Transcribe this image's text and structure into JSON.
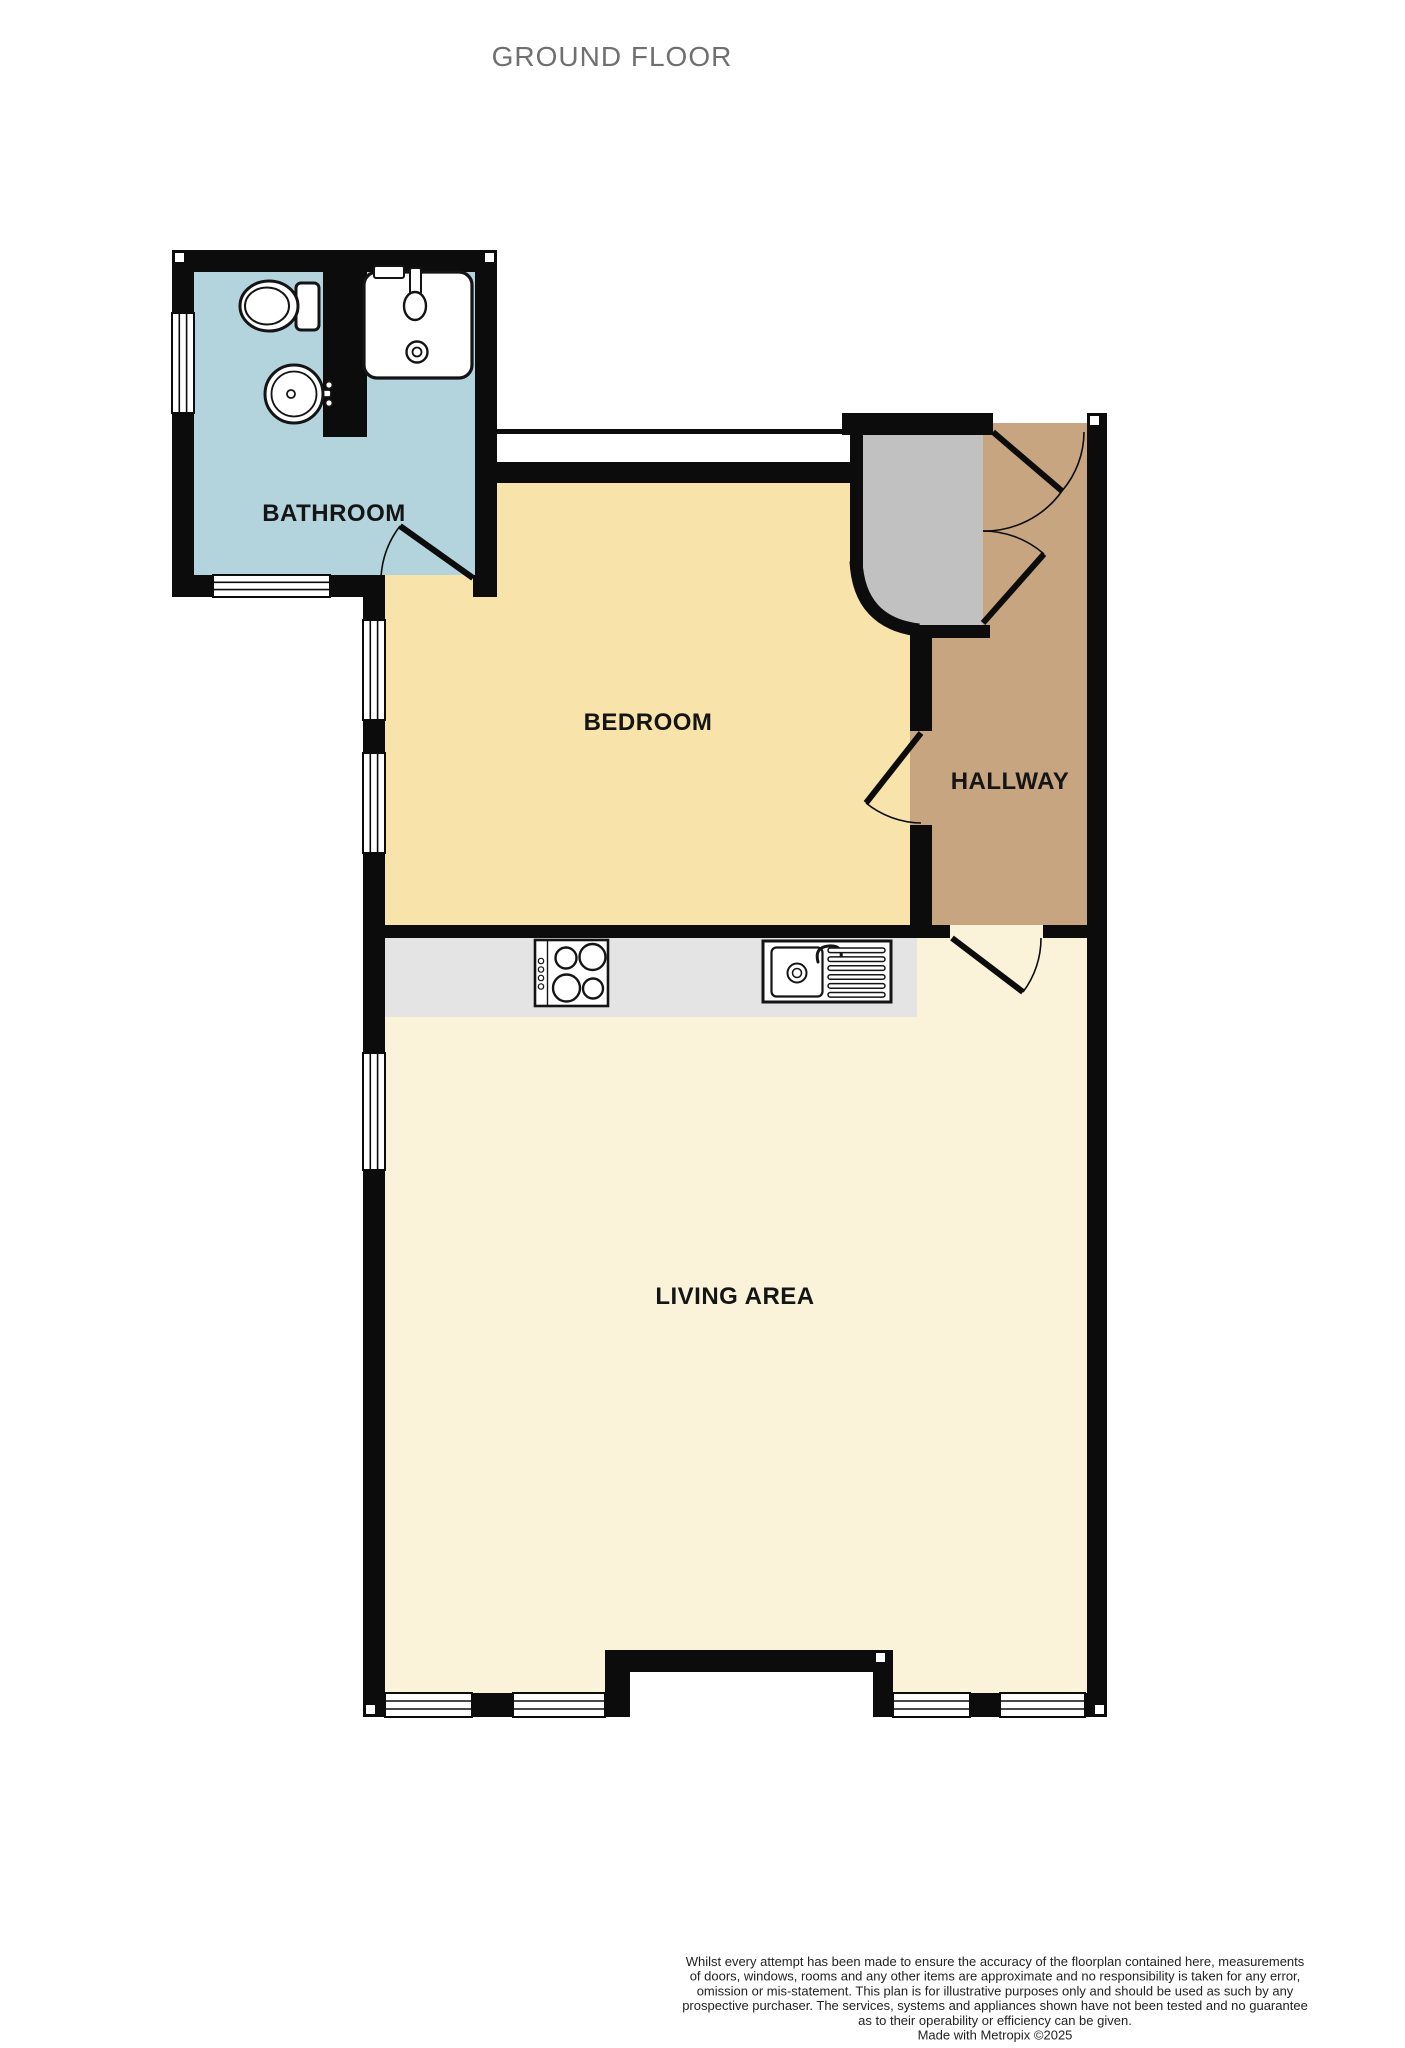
{
  "title": "GROUND FLOOR",
  "rooms": {
    "bathroom": {
      "label": "BATHROOM"
    },
    "bedroom": {
      "label": "BEDROOM"
    },
    "hallway": {
      "label": "HALLWAY"
    },
    "living_area": {
      "label": "LIVING AREA"
    }
  },
  "fixtures": {
    "bathroom": [
      "toilet-icon",
      "pedestal-basin-icon",
      "washbasin-icon"
    ],
    "kitchen": [
      "hob-icon",
      "sink-drainer-icon"
    ]
  },
  "colors": {
    "bathroom_floor": "#b4d4dd",
    "bedroom_floor": "#f8e4ab",
    "hallway_floor": "#c6a580",
    "living_floor": "#faf3da",
    "vestibule_floor": "#c2c1c1",
    "counter_floor": "#e4e4e4",
    "wall": "#0c0c0c",
    "title_text": "#6f6f6f",
    "label_text": "#151515",
    "disclaimer_text": "#222222"
  },
  "disclaimer": {
    "lines": [
      "Whilst every attempt has been made to ensure the accuracy of the floorplan contained here, measurements",
      "of doors, windows, rooms and any other items are approximate and no responsibility is taken for any error,",
      "omission or mis-statement. This plan is for illustrative purposes only and should be used as such by any",
      "prospective purchaser. The services, systems and appliances shown have not been tested and no guarantee",
      "as to their operability or efficiency can be given.",
      "Made with Metropix ©2025"
    ]
  }
}
